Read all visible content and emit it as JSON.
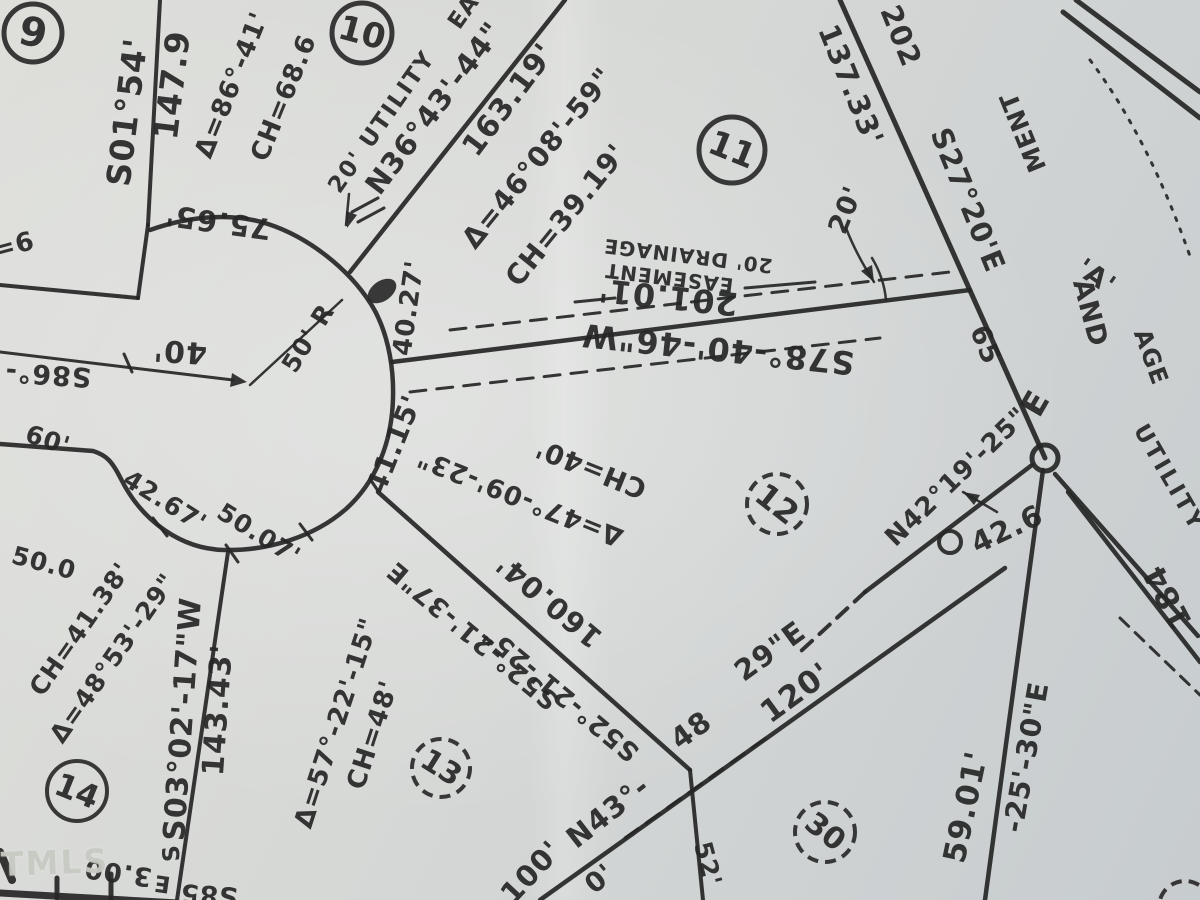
{
  "map": {
    "width": 1200,
    "height": 900,
    "colors": {
      "ink": "#262626",
      "paper_light": "#dedfdb",
      "paper_dark": "#c7cccf",
      "watermark": "#c8cac3"
    },
    "watermark": {
      "text": "TMLS"
    },
    "lots": [
      {
        "label": "9",
        "cx": 33,
        "cy": 33,
        "r": 29,
        "rot": 12,
        "fs": 40,
        "dashed": false,
        "w": 5
      },
      {
        "label": "10",
        "cx": 362,
        "cy": 33,
        "r": 30,
        "rot": 15,
        "fs": 34,
        "dashed": false,
        "w": 5
      },
      {
        "label": "11",
        "cx": 732,
        "cy": 150,
        "r": 33,
        "rot": 22,
        "fs": 34,
        "dashed": false,
        "w": 5
      },
      {
        "label": "12",
        "cx": 777,
        "cy": 504,
        "r": 30,
        "rot": 38,
        "fs": 32,
        "dashed": true,
        "w": 4
      },
      {
        "label": "13",
        "cx": 441,
        "cy": 768,
        "r": 29,
        "rot": 32,
        "fs": 30,
        "dashed": true,
        "w": 4
      },
      {
        "label": "14",
        "cx": 77,
        "cy": 791,
        "r": 30,
        "rot": 22,
        "fs": 32,
        "dashed": false,
        "w": 4
      },
      {
        "label": "30",
        "cx": 825,
        "cy": 832,
        "r": 30,
        "rot": 38,
        "fs": 30,
        "dashed": true,
        "w": 4
      },
      {
        "label": "",
        "cx": 1185,
        "cy": 907,
        "r": 26,
        "rot": 0,
        "fs": 30,
        "dashed": true,
        "w": 4
      }
    ],
    "labels": [
      {
        "t": "S01°54'",
        "x": 127,
        "y": 112,
        "r": -83,
        "s": 33
      },
      {
        "t": "147.9",
        "x": 172,
        "y": 85,
        "r": -83,
        "s": 33
      },
      {
        "t": "Δ=86°-41'",
        "x": 232,
        "y": 85,
        "r": -68,
        "s": 26
      },
      {
        "t": "CH=68.6",
        "x": 284,
        "y": 98,
        "r": -68,
        "s": 26
      },
      {
        "t": "75.65'",
        "x": 218,
        "y": 222,
        "r": 188,
        "s": 29
      },
      {
        "t": "=6",
        "x": 14,
        "y": 246,
        "r": -15,
        "s": 26
      },
      {
        "t": "S86°-",
        "x": 48,
        "y": 374,
        "r": 184,
        "s": 27
      },
      {
        "t": "40'",
        "x": 180,
        "y": 351,
        "r": 184,
        "s": 30
      },
      {
        "t": "60'",
        "x": 48,
        "y": 440,
        "r": 18,
        "s": 25
      },
      {
        "t": "50' R",
        "x": 308,
        "y": 338,
        "r": -58,
        "s": 25
      },
      {
        "t": "40.27'",
        "x": 409,
        "y": 308,
        "r": -82,
        "s": 26
      },
      {
        "t": "41.15'",
        "x": 394,
        "y": 444,
        "r": -68,
        "s": 28
      },
      {
        "t": "42.67'",
        "x": 165,
        "y": 501,
        "r": 32,
        "s": 25
      },
      {
        "t": "50.07'",
        "x": 259,
        "y": 534,
        "r": 32,
        "s": 25
      },
      {
        "t": "50.0",
        "x": 44,
        "y": 563,
        "r": 15,
        "s": 25
      },
      {
        "t": "20' UTILITY",
        "x": 382,
        "y": 122,
        "r": -55,
        "s": 23,
        "ls": 2
      },
      {
        "t": "EA",
        "x": 464,
        "y": 12,
        "r": -55,
        "s": 23
      },
      {
        "t": "N36°43'-44\"",
        "x": 434,
        "y": 108,
        "r": -53,
        "s": 29
      },
      {
        "t": "163.19'",
        "x": 509,
        "y": 100,
        "r": -53,
        "s": 30
      },
      {
        "t": "Δ=46°08'-59\"",
        "x": 538,
        "y": 158,
        "r": -51,
        "s": 28
      },
      {
        "t": "CH=39.19'",
        "x": 566,
        "y": 215,
        "r": -51,
        "s": 28
      },
      {
        "t": "20'",
        "x": 846,
        "y": 210,
        "r": -68,
        "s": 27
      },
      {
        "t": "20' DRAINAGE",
        "x": 688,
        "y": 256,
        "r": 187,
        "s": 20,
        "ls": 1
      },
      {
        "t": "EASEMENT",
        "x": 669,
        "y": 278,
        "r": 187,
        "s": 20,
        "ls": 1
      },
      {
        "t": "201.01'",
        "x": 668,
        "y": 297,
        "r": 186,
        "s": 32
      },
      {
        "t": "S78°-40'-46\"W",
        "x": 718,
        "y": 349,
        "r": 186,
        "s": 32,
        "ls": 1
      },
      {
        "t": "137.33'",
        "x": 851,
        "y": 85,
        "r": 68,
        "s": 29
      },
      {
        "t": "202",
        "x": 901,
        "y": 36,
        "r": 68,
        "s": 29
      },
      {
        "t": "S27°20'E",
        "x": 968,
        "y": 200,
        "r": 68,
        "s": 29
      },
      {
        "t": "65",
        "x": 985,
        "y": 345,
        "r": 68,
        "s": 27
      },
      {
        "t": "MENT",
        "x": 1023,
        "y": 132,
        "r": 248,
        "s": 25,
        "o": 0.5
      },
      {
        "t": "'A'",
        "x": 1096,
        "y": 277,
        "r": 35,
        "s": 27,
        "o": 0.6
      },
      {
        "t": "AND",
        "x": 1090,
        "y": 313,
        "r": 75,
        "s": 27,
        "o": 0.5
      },
      {
        "t": "AGE",
        "x": 1151,
        "y": 357,
        "r": 70,
        "s": 24,
        "o": 0.45
      },
      {
        "t": "UTILITY",
        "x": 1169,
        "y": 478,
        "r": 60,
        "s": 23,
        "o": 0.55,
        "ls": 3
      },
      {
        "t": "E",
        "x": 1035,
        "y": 403,
        "r": -60,
        "s": 33
      },
      {
        "t": "N42°19'-25\"",
        "x": 957,
        "y": 477,
        "r": -44,
        "s": 26
      },
      {
        "t": "42.6",
        "x": 1007,
        "y": 529,
        "r": -25,
        "s": 29
      },
      {
        "t": "184",
        "x": 1168,
        "y": 597,
        "r": 242,
        "s": 31
      },
      {
        "t": "59.01'",
        "x": 966,
        "y": 807,
        "r": -78,
        "s": 31
      },
      {
        "t": "-25'-30\"E",
        "x": 1026,
        "y": 757,
        "r": -80,
        "s": 28,
        "o": 0.55
      },
      {
        "t": "Δ=47°-09'-23\"",
        "x": 520,
        "y": 497,
        "r": 202,
        "s": 26
      },
      {
        "t": "CH=40'",
        "x": 591,
        "y": 468,
        "r": 202,
        "s": 27
      },
      {
        "t": "160.04'",
        "x": 549,
        "y": 601,
        "r": 220,
        "s": 29
      },
      {
        "t": "S52°-21'-37\"E",
        "x": 473,
        "y": 635,
        "r": 220,
        "s": 26
      },
      {
        "t": "S52°-21'-25\"",
        "x": 561,
        "y": 693,
        "r": 220,
        "s": 26
      },
      {
        "t": "Δ=57°-22'-15\"",
        "x": 337,
        "y": 723,
        "r": -72,
        "s": 26
      },
      {
        "t": "CH=48'",
        "x": 373,
        "y": 735,
        "r": -72,
        "s": 26
      },
      {
        "t": "CH=41.38'",
        "x": 80,
        "y": 629,
        "r": -55,
        "s": 25
      },
      {
        "t": "Δ=48°53'-29\"",
        "x": 113,
        "y": 658,
        "r": -55,
        "s": 25
      },
      {
        "t": "S03°02'-17\"W",
        "x": 183,
        "y": 719,
        "r": -86,
        "s": 30
      },
      {
        "t": "143.43'",
        "x": 218,
        "y": 710,
        "r": -86,
        "s": 30
      },
      {
        "t": "100'",
        "x": 531,
        "y": 872,
        "r": -47,
        "s": 29
      },
      {
        "t": "0'",
        "x": 600,
        "y": 879,
        "r": -40,
        "s": 27
      },
      {
        "t": "N43°-",
        "x": 608,
        "y": 812,
        "r": -38,
        "s": 29
      },
      {
        "t": "48",
        "x": 691,
        "y": 730,
        "r": -36,
        "s": 29
      },
      {
        "t": "29\"E",
        "x": 770,
        "y": 651,
        "r": -36,
        "s": 29
      },
      {
        "t": "120'",
        "x": 796,
        "y": 693,
        "r": -36,
        "s": 31
      },
      {
        "t": "52'",
        "x": 708,
        "y": 864,
        "r": 75,
        "s": 25
      },
      {
        "t": "3.00",
        "x": 118,
        "y": 872,
        "r": 188,
        "s": 26
      },
      {
        "t": "E",
        "x": 162,
        "y": 883,
        "r": 188,
        "s": 23
      },
      {
        "t": "S85",
        "x": 209,
        "y": 894,
        "r": 184,
        "s": 26
      },
      {
        "t": "S",
        "x": 172,
        "y": 853,
        "r": -95,
        "s": 23
      }
    ],
    "lines": [
      {
        "x1": 160,
        "y1": 0,
        "x2": 148,
        "y2": 225,
        "w": 4
      },
      {
        "x1": 148,
        "y1": 225,
        "x2": 138,
        "y2": 298,
        "w": 4
      },
      {
        "x1": 138,
        "y1": 298,
        "x2": 0,
        "y2": 285,
        "w": 4
      },
      {
        "x1": 0,
        "y1": 352,
        "x2": 233,
        "y2": 380,
        "w": 3
      },
      {
        "x1": 124,
        "y1": 354,
        "x2": 132,
        "y2": 372,
        "w": 3
      },
      {
        "x1": 250,
        "y1": 385,
        "x2": 342,
        "y2": 300,
        "w": 2.5
      },
      {
        "x1": 350,
        "y1": 272,
        "x2": 565,
        "y2": 0,
        "w": 4.5
      },
      {
        "x1": 358,
        "y1": 222,
        "x2": 384,
        "y2": 208,
        "w": 3
      },
      {
        "x1": 352,
        "y1": 212,
        "x2": 378,
        "y2": 198,
        "w": 3
      },
      {
        "x1": 392,
        "y1": 362,
        "x2": 970,
        "y2": 290,
        "w": 4.5
      },
      {
        "x1": 378,
        "y1": 492,
        "x2": 690,
        "y2": 770,
        "w": 4.5
      },
      {
        "x1": 228,
        "y1": 552,
        "x2": 177,
        "y2": 900,
        "w": 4
      },
      {
        "x1": 840,
        "y1": 0,
        "x2": 1045,
        "y2": 458,
        "w": 5
      },
      {
        "x1": 865,
        "y1": 592,
        "x2": 1032,
        "y2": 465,
        "w": 4.5
      },
      {
        "x1": 1043,
        "y1": 470,
        "x2": 985,
        "y2": 900,
        "w": 4.5
      },
      {
        "x1": 1055,
        "y1": 474,
        "x2": 1198,
        "y2": 636,
        "w": 4.5
      },
      {
        "x1": 1068,
        "y1": 492,
        "x2": 1200,
        "y2": 662,
        "w": 4.5
      },
      {
        "x1": 1063,
        "y1": 12,
        "x2": 1200,
        "y2": 118,
        "w": 5
      },
      {
        "x1": 1076,
        "y1": 0,
        "x2": 1200,
        "y2": 92,
        "w": 5
      },
      {
        "x1": 540,
        "y1": 900,
        "x2": 1005,
        "y2": 568,
        "w": 4.5
      },
      {
        "x1": 690,
        "y1": 770,
        "x2": 703,
        "y2": 900,
        "w": 4
      },
      {
        "x1": 575,
        "y1": 302,
        "x2": 615,
        "y2": 298,
        "w": 3
      },
      {
        "x1": 745,
        "y1": 288,
        "x2": 815,
        "y2": 282,
        "w": 3
      },
      {
        "x1": 997,
        "y1": 512,
        "x2": 963,
        "y2": 492,
        "w": 2.5
      },
      {
        "x1": 349,
        "y1": 194,
        "x2": 346,
        "y2": 225,
        "w": 2.5
      },
      {
        "x1": 153,
        "y1": 518,
        "x2": 167,
        "y2": 536,
        "w": 3
      },
      {
        "x1": 226,
        "y1": 545,
        "x2": 238,
        "y2": 562,
        "w": 3
      },
      {
        "x1": 300,
        "y1": 524,
        "x2": 312,
        "y2": 540,
        "w": 3
      },
      {
        "x1": 0,
        "y1": 893,
        "x2": 178,
        "y2": 903,
        "w": 7
      },
      {
        "x1": 111,
        "y1": 874,
        "x2": 111,
        "y2": 898,
        "w": 5
      },
      {
        "x1": 57,
        "y1": 878,
        "x2": 57,
        "y2": 898,
        "w": 5
      },
      {
        "x1": 0,
        "y1": 852,
        "x2": 12,
        "y2": 880,
        "w": 8
      },
      {
        "x1": 450,
        "y1": 330,
        "x2": 950,
        "y2": 272,
        "w": 3,
        "dash": "16 11"
      },
      {
        "x1": 410,
        "y1": 392,
        "x2": 880,
        "y2": 338,
        "w": 3,
        "dash": "16 11"
      },
      {
        "x1": 865,
        "y1": 592,
        "x2": 800,
        "y2": 652,
        "w": 4,
        "dash": "14 10"
      },
      {
        "x1": 625,
        "y1": 838,
        "x2": 770,
        "y2": 735,
        "w": 3,
        "dash": "16 10"
      },
      {
        "x1": 1120,
        "y1": 618,
        "x2": 1200,
        "y2": 695,
        "w": 3,
        "dash": "12 9"
      }
    ],
    "paths": [
      {
        "d": "M150,230 C192,215 235,213 268,224 C308,237 348,268 371,304 C386,328 394,362 393,398 C392,442 376,482 346,509 C314,537 268,551 224,550 C181,549 142,521 121,479 C112,461 106,455 93,451 L0,444",
        "w": 4.5
      },
      {
        "d": "M1090,60 Q1150,140 1192,262",
        "w": 3,
        "dash": "3 9"
      },
      {
        "d": "M846,228 Q856,254 874,282",
        "w": 2.5
      },
      {
        "d": "M872,258 Q884,278 886,300",
        "w": 2.5
      }
    ],
    "nodes": [
      {
        "cx": 1045,
        "cy": 458,
        "r": 13,
        "w": 5
      },
      {
        "cx": 950,
        "cy": 542,
        "r": 11,
        "w": 4
      }
    ],
    "blobs": [
      {
        "cx": 382,
        "cy": 291,
        "rx": 16,
        "ry": 10,
        "rot": -35
      }
    ],
    "arrowheads": [
      {
        "points": "247,382 230,387 232,373"
      },
      {
        "points": "347,228 346,211 357,215"
      },
      {
        "points": "874,282 861,271 872,265"
      },
      {
        "points": "963,492 980,495 974,505"
      }
    ]
  }
}
